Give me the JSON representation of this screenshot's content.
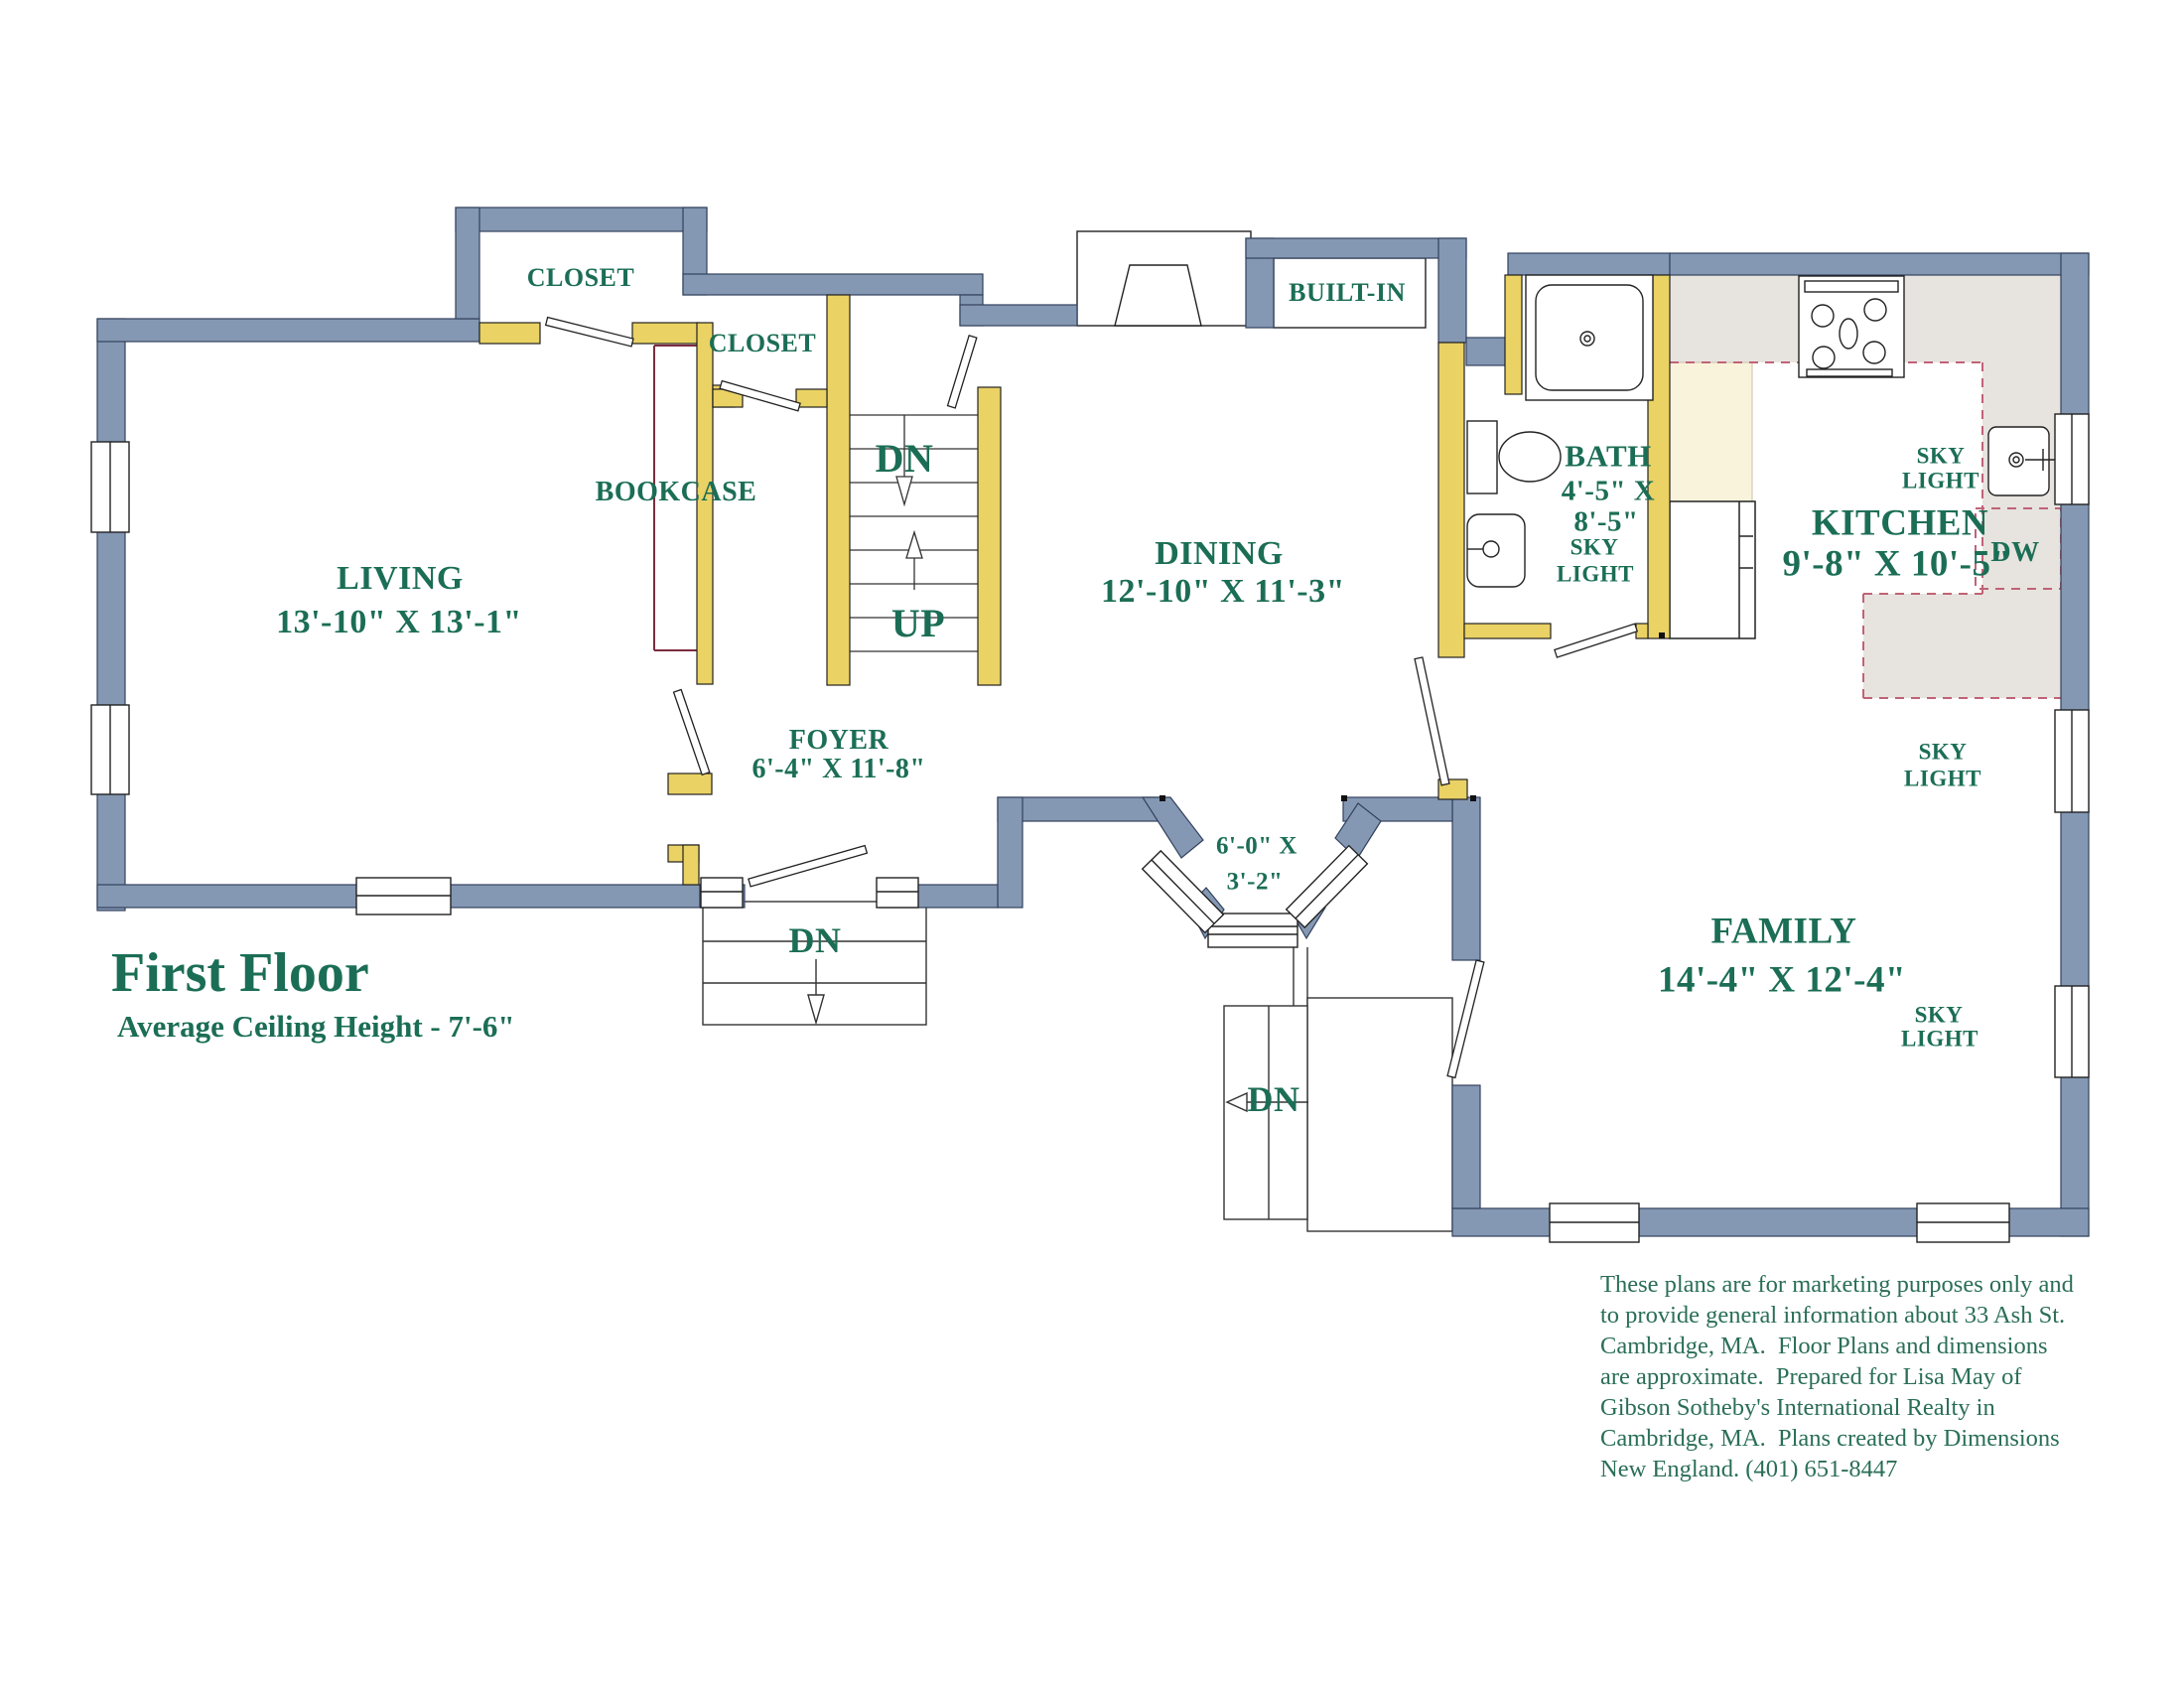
{
  "title": {
    "heading": "First Floor",
    "subtitle": "Average Ceiling Height - 7'-6\""
  },
  "rooms": {
    "living": {
      "name": "LIVING",
      "dims": "13'-10\" X 13'-1\""
    },
    "dining": {
      "name": "DINING",
      "dims": "12'-10\" X 11'-3\""
    },
    "kitchen": {
      "name": "KITCHEN",
      "dims": "9'-8\" X 10'-5\""
    },
    "family": {
      "name": "FAMILY",
      "dims": "14'-4\" X 12'-4\""
    },
    "foyer": {
      "name": "FOYER",
      "dims": "6'-4\" X 11'-8\""
    },
    "bath": {
      "name": "BATH",
      "dims_line1": "4'-5\" X",
      "dims_line2": "8'-5\""
    }
  },
  "labels": {
    "closet_top_left": "CLOSET",
    "closet_foyer": "CLOSET",
    "bookcase": "BOOKCASE",
    "built_in": "BUILT-IN",
    "dishwasher": "DW",
    "sky_light": {
      "line1": "SKY",
      "line2": "LIGHT"
    },
    "down": "DN",
    "up": "UP",
    "bay_dims": {
      "line1": "6'-0\" X",
      "line2": "3'-2\""
    }
  },
  "disclaimer": {
    "lines": [
      "These plans are for marketing purposes only and",
      "to provide general information about 33 Ash St.",
      "Cambridge, MA.  Floor Plans and dimensions",
      "are approximate.  Prepared for Lisa May of",
      "Gibson Sotheby's International Realty in",
      "Cambridge, MA.  Plans created by Dimensions",
      "New England. (401) 651-8447"
    ]
  },
  "colors": {
    "exterior_wall_blue": "#8498b4",
    "interior_wall_yellow": "#ead264",
    "label_green": "#1b6e55",
    "counter_gray": "#e7e3de",
    "pantry_cream": "#faf3dc",
    "counter_dash_red": "#c06377",
    "bookcase_maroon": "#7b2c3e"
  }
}
